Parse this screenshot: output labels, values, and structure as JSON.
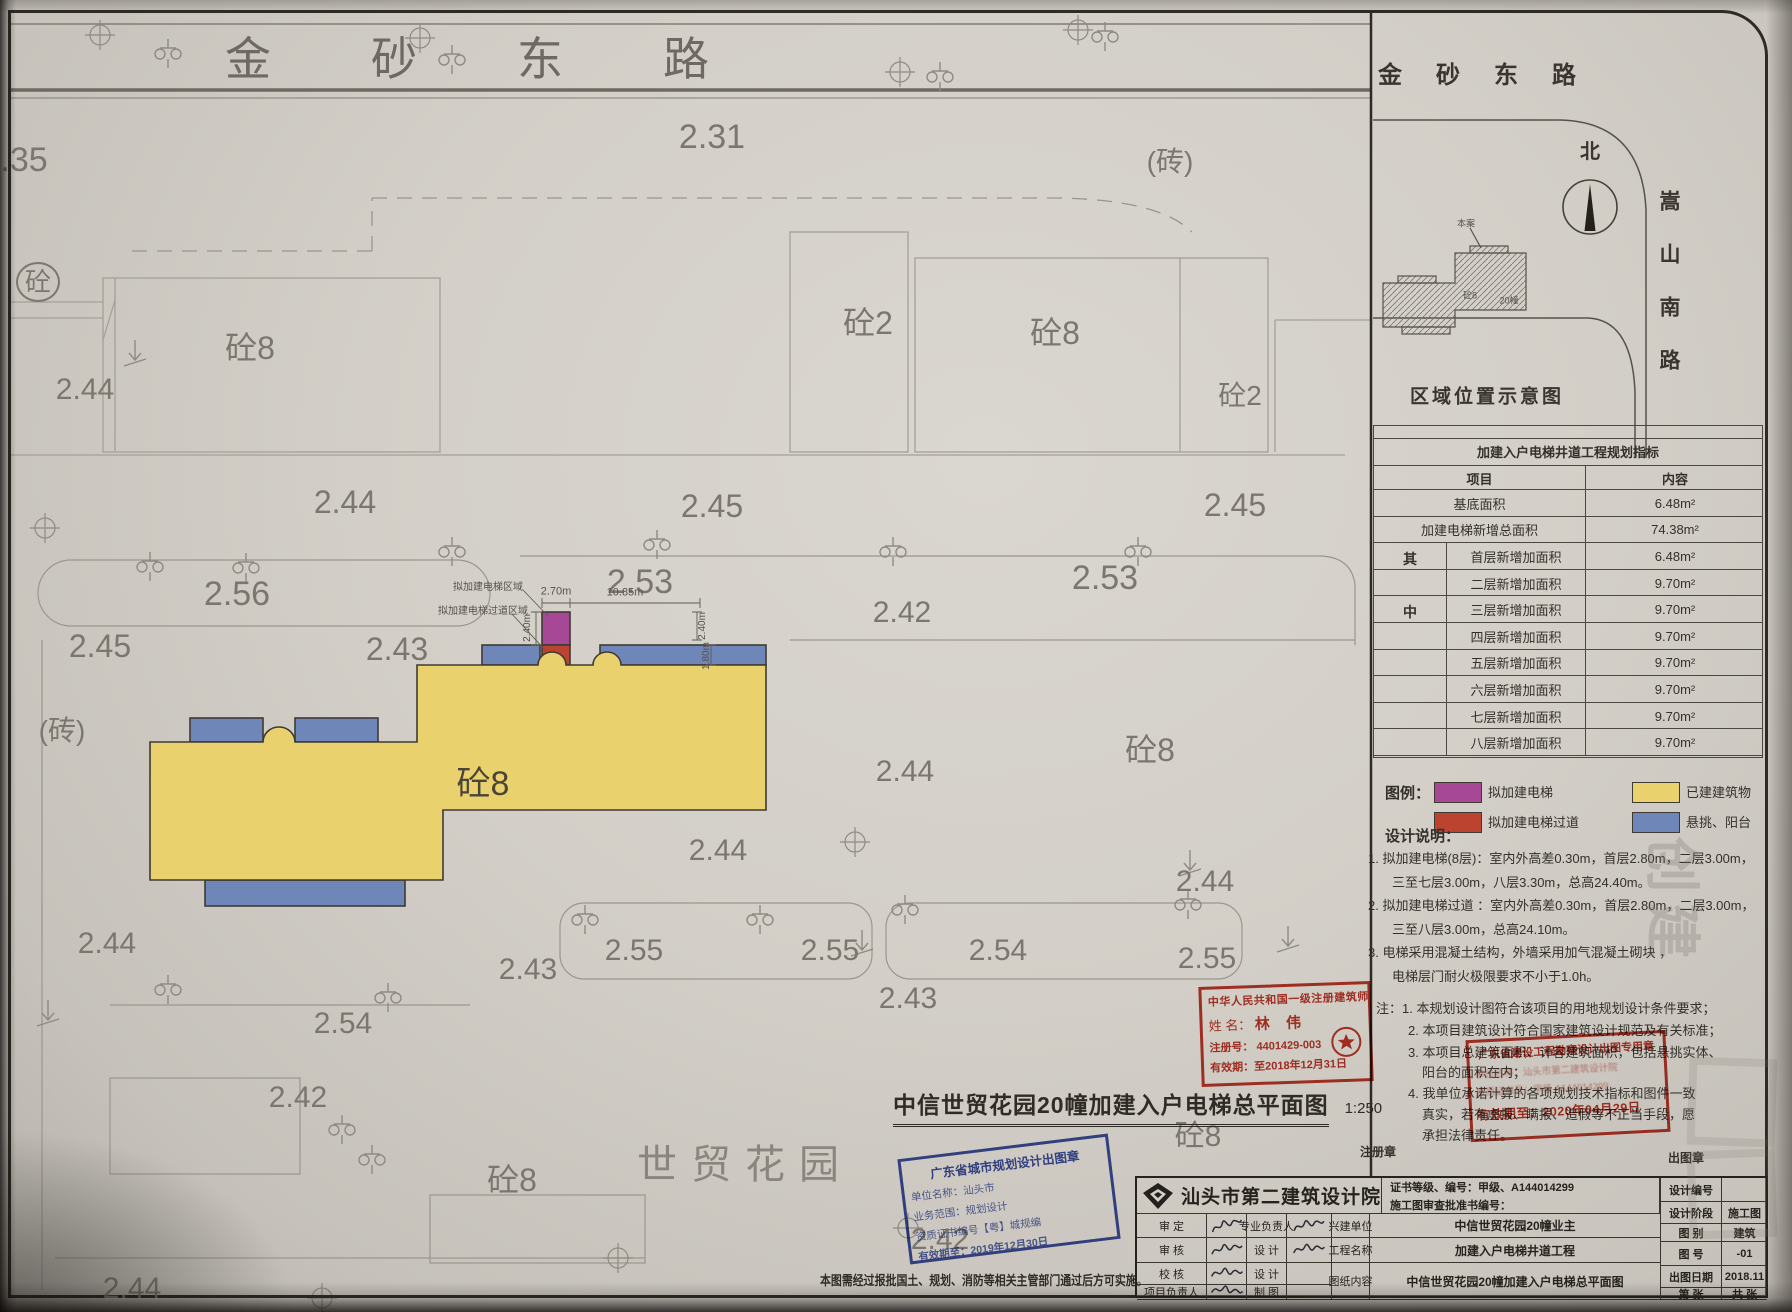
{
  "colors": {
    "existing_building": "#e9d26d",
    "balcony": "#6e86b8",
    "proposed_elevator": "#a74897",
    "proposed_corridor": "#bb4330",
    "stamp_red": "#c0392b",
    "stamp_blue": "#3d50a5"
  },
  "road": {
    "name": "金砂东路"
  },
  "site_text": "世贸花园",
  "plan": {
    "labels": [
      {
        "t": "2.31",
        "x": 712,
        "y": 137,
        "s": 34,
        "n": "elevation-label"
      },
      {
        "t": "(砖)",
        "x": 1170,
        "y": 162,
        "s": 28,
        "n": "material-label"
      },
      {
        "t": ".35",
        "x": 24,
        "y": 160,
        "s": 34,
        "n": "elevation-label"
      },
      {
        "t": "砼",
        "x": 38,
        "y": 282,
        "s": 26,
        "cls": "circ",
        "n": "material-label"
      },
      {
        "t": "2.44",
        "x": 85,
        "y": 390,
        "s": 30,
        "n": "elevation-label"
      },
      {
        "t": "砼8",
        "x": 250,
        "y": 348,
        "s": 32,
        "n": "building-label"
      },
      {
        "t": "砼2",
        "x": 868,
        "y": 323,
        "s": 32,
        "n": "building-label"
      },
      {
        "t": "砼8",
        "x": 1055,
        "y": 333,
        "s": 32,
        "n": "building-label"
      },
      {
        "t": "砼2",
        "x": 1240,
        "y": 396,
        "s": 28,
        "n": "building-label"
      },
      {
        "t": "2.44",
        "x": 345,
        "y": 502,
        "s": 32,
        "n": "elevation-label"
      },
      {
        "t": "2.45",
        "x": 712,
        "y": 506,
        "s": 32,
        "n": "elevation-label"
      },
      {
        "t": "2.45",
        "x": 1235,
        "y": 505,
        "s": 32,
        "n": "elevation-label"
      },
      {
        "t": "2.56",
        "x": 237,
        "y": 594,
        "s": 34,
        "n": "elevation-label"
      },
      {
        "t": "2.53",
        "x": 640,
        "y": 582,
        "s": 34,
        "n": "elevation-label"
      },
      {
        "t": "2.53",
        "x": 1105,
        "y": 578,
        "s": 34,
        "n": "elevation-label"
      },
      {
        "t": "2.42",
        "x": 902,
        "y": 613,
        "s": 30,
        "n": "elevation-label"
      },
      {
        "t": "2.45",
        "x": 100,
        "y": 646,
        "s": 32,
        "n": "elevation-label"
      },
      {
        "t": "2.43",
        "x": 397,
        "y": 649,
        "s": 32,
        "n": "elevation-label"
      },
      {
        "t": "(砖)",
        "x": 62,
        "y": 731,
        "s": 28,
        "n": "material-label"
      },
      {
        "t": "砼8",
        "x": 483,
        "y": 784,
        "s": 34,
        "cls": "dk",
        "n": "building-label"
      },
      {
        "t": "2.44",
        "x": 905,
        "y": 772,
        "s": 30,
        "n": "elevation-label"
      },
      {
        "t": "砼8",
        "x": 1150,
        "y": 750,
        "s": 32,
        "n": "building-label"
      },
      {
        "t": "2.44",
        "x": 718,
        "y": 851,
        "s": 30,
        "n": "elevation-label"
      },
      {
        "t": "2.44",
        "x": 1205,
        "y": 882,
        "s": 30,
        "n": "elevation-label"
      },
      {
        "t": "2.44",
        "x": 107,
        "y": 944,
        "s": 30,
        "n": "elevation-label"
      },
      {
        "t": "2.43",
        "x": 528,
        "y": 970,
        "s": 30,
        "n": "elevation-label"
      },
      {
        "t": "2.55",
        "x": 634,
        "y": 951,
        "s": 30,
        "n": "elevation-label"
      },
      {
        "t": "2.55",
        "x": 830,
        "y": 951,
        "s": 30,
        "n": "elevation-label"
      },
      {
        "t": "2.54",
        "x": 998,
        "y": 951,
        "s": 30,
        "n": "elevation-label"
      },
      {
        "t": "2.55",
        "x": 1207,
        "y": 959,
        "s": 30,
        "n": "elevation-label"
      },
      {
        "t": "2.43",
        "x": 908,
        "y": 999,
        "s": 30,
        "n": "elevation-label"
      },
      {
        "t": "2.54",
        "x": 343,
        "y": 1024,
        "s": 30,
        "n": "elevation-label"
      },
      {
        "t": "2.42",
        "x": 298,
        "y": 1098,
        "s": 30,
        "n": "elevation-label"
      },
      {
        "t": "砼8",
        "x": 512,
        "y": 1180,
        "s": 32,
        "n": "building-label"
      },
      {
        "t": "砼8",
        "x": 1198,
        "y": 1137,
        "s": 30,
        "n": "building-label"
      },
      {
        "t": "2.42",
        "x": 940,
        "y": 1240,
        "s": 30,
        "n": "elevation-label"
      },
      {
        "t": "2.44",
        "x": 132,
        "y": 1289,
        "s": 30,
        "n": "elevation-label"
      },
      {
        "t": "2.70m",
        "x": 556,
        "y": 592,
        "s": 11,
        "cls": "dim",
        "n": "dimension-label"
      },
      {
        "t": "10.85m",
        "x": 625,
        "y": 593,
        "s": 11,
        "cls": "dim",
        "n": "dimension-label"
      },
      {
        "t": "2.40m",
        "x": 528,
        "y": 628,
        "s": 10,
        "cls": "dim",
        "r": -90,
        "n": "dimension-label"
      },
      {
        "t": "2.40m",
        "x": 703,
        "y": 626,
        "s": 10,
        "cls": "dim",
        "r": -90,
        "n": "dimension-label"
      },
      {
        "t": "1.80m",
        "x": 707,
        "y": 656,
        "s": 10,
        "cls": "dim",
        "r": -90,
        "n": "dimension-label"
      },
      {
        "t": "拟加建电梯区域",
        "x": 488,
        "y": 588,
        "s": 10,
        "cls": "dim",
        "n": "area-annotation"
      },
      {
        "t": "拟加建电梯过道区域",
        "x": 483,
        "y": 612,
        "s": 10,
        "cls": "dim",
        "n": "area-annotation"
      }
    ]
  },
  "inset": {
    "road_top": "金砂东路",
    "north": "北",
    "road_right": "嵩山南路",
    "site_ref": "本案",
    "bld_a": "砼8",
    "bld_b": "20幢",
    "caption": "区域位置示意图"
  },
  "indicator_table": {
    "title": "加建入户电梯井道工程规划指标",
    "col_item": "项目",
    "col_content": "内容",
    "group_chars": [
      "其",
      "中"
    ],
    "rows": [
      {
        "item": "基底面积",
        "value": "6.48m²",
        "group": false
      },
      {
        "item": "加建电梯新增总面积",
        "value": "74.38m²",
        "group": false
      },
      {
        "item": "首层新增加面积",
        "value": "6.48m²",
        "group": true
      },
      {
        "item": "二层新增加面积",
        "value": "9.70m²",
        "group": true
      },
      {
        "item": "三层新增加面积",
        "value": "9.70m²",
        "group": true
      },
      {
        "item": "四层新增加面积",
        "value": "9.70m²",
        "group": true
      },
      {
        "item": "五层新增加面积",
        "value": "9.70m²",
        "group": true
      },
      {
        "item": "六层新增加面积",
        "value": "9.70m²",
        "group": true
      },
      {
        "item": "七层新增加面积",
        "value": "9.70m²",
        "group": true
      },
      {
        "item": "八层新增加面积",
        "value": "9.70m²",
        "group": true
      }
    ]
  },
  "legend": {
    "heading": "图例：",
    "items": [
      {
        "color": "#a74897",
        "label": "拟加建电梯",
        "col": 0,
        "row": 0
      },
      {
        "color": "#bb4330",
        "label": "拟加建电梯过道",
        "col": 0,
        "row": 1
      },
      {
        "color": "#e9d26d",
        "label": "已建建筑物",
        "col": 1,
        "row": 0
      },
      {
        "color": "#6e86b8",
        "label": "悬挑、阳台",
        "col": 1,
        "row": 1
      }
    ]
  },
  "design_notes": {
    "heading": "设计说明：",
    "lines": [
      {
        "t": "1. 拟加建电梯(8层)：室内外高差0.30m，首层2.80m，二层3.00m，",
        "x": 1368,
        "y": 852
      },
      {
        "t": "三至七层3.00m，八层3.30m，总高24.40m。",
        "x": 1392,
        "y": 876
      },
      {
        "t": "2. 拟加建电梯过道 ：室内外高差0.30m，首层2.80m，二层3.00m，",
        "x": 1368,
        "y": 899
      },
      {
        "t": "三至八层3.00m，总高24.10m。",
        "x": 1392,
        "y": 923
      },
      {
        "t": "3. 电梯采用混凝土结构，外墙采用加气混凝土砌块 ，",
        "x": 1368,
        "y": 946
      },
      {
        "t": "电梯层门耐火极限要求不小于1.0h。",
        "x": 1392,
        "y": 970
      }
    ]
  },
  "remarks": {
    "lines": [
      {
        "t": "注：1. 本规划设计图符合该项目的用地规划设计条件要求；",
        "x": 1376,
        "y": 1002
      },
      {
        "t": "2. 本项目建筑设计符合国家建筑设计规范及有关标准；",
        "x": 1408,
        "y": 1024
      },
      {
        "t": "3. 本项目总建筑面积、计容建筑面积，包括悬挑实体、",
        "x": 1408,
        "y": 1046
      },
      {
        "t": "阳台的面积在内；",
        "x": 1422,
        "y": 1066
      },
      {
        "t": "4. 我单位承诺计算的各项规划技术指标和图件一致",
        "x": 1408,
        "y": 1087
      },
      {
        "t": "真实，若有虚报、瞒报、造假等不正当手段，愿",
        "x": 1422,
        "y": 1108
      },
      {
        "t": "承担法律责任。",
        "x": 1422,
        "y": 1129
      }
    ]
  },
  "seal_captions": {
    "reg": "注册章",
    "out": "出图章"
  },
  "architect_stamp": {
    "line1": "中华人民共和国一级注册建筑师",
    "name_label": "姓 名：",
    "name": "林 伟",
    "reg": "注册号： 4401429-003",
    "valid": "有效期：至2018年12月31日"
  },
  "survey_stamp": {
    "line1": "广东省建设工程勘察设计出图专用章",
    "line2": "单位名称：汕头市第二建筑设计院",
    "line3": "资质证书号：甲级 A144014299",
    "line4": "有效期至：2020年04月29日"
  },
  "planning_stamp": {
    "line1": "广东省城市规划设计出图章",
    "line2": "单位名称：汕头市",
    "line3": "业务范围：规划设计",
    "line4": "资质证书编号【粤】城规编",
    "line5": "有效期至：2019年12月30日"
  },
  "main_title": {
    "text": "中信世贸花园20幢加建入户电梯总平面图",
    "scale": "1:250"
  },
  "bottom_note": "本图需经过报批国土、规划、消防等相关主管部门通过后方可实施。",
  "title_block": {
    "institute": "汕头市第二建筑设计院",
    "cert": "证书等级、编号：甲级、A144014299",
    "review": "施工图审查批准书编号：",
    "rows": [
      {
        "l1": "审  定",
        "l2": "专业负责人",
        "l3": "兴建单位",
        "v": "中信世贸花园20幢业主"
      },
      {
        "l1": "审  核",
        "l2": "设  计",
        "l3": "工程名称",
        "v": "加建入户电梯井道工程"
      },
      {
        "l1": "校  核",
        "l2": "设  计",
        "l3": "图纸内容",
        "v": "中信世贸花园20幢加建入户电梯总平面图"
      },
      {
        "l1": "项目负责人",
        "l2": "制  图",
        "l3": "",
        "v": ""
      }
    ],
    "right_rows": [
      {
        "label": "设计编号",
        "value": ""
      },
      {
        "label": "设计阶段",
        "value": "施工图"
      },
      {
        "label": "图  别",
        "value": "建筑"
      },
      {
        "label": "图  号",
        "value": "-01"
      },
      {
        "label": "出图日期",
        "value": "2018.11"
      },
      {
        "label": "第    张",
        "value": "共    张"
      }
    ]
  },
  "watermark": "创建"
}
